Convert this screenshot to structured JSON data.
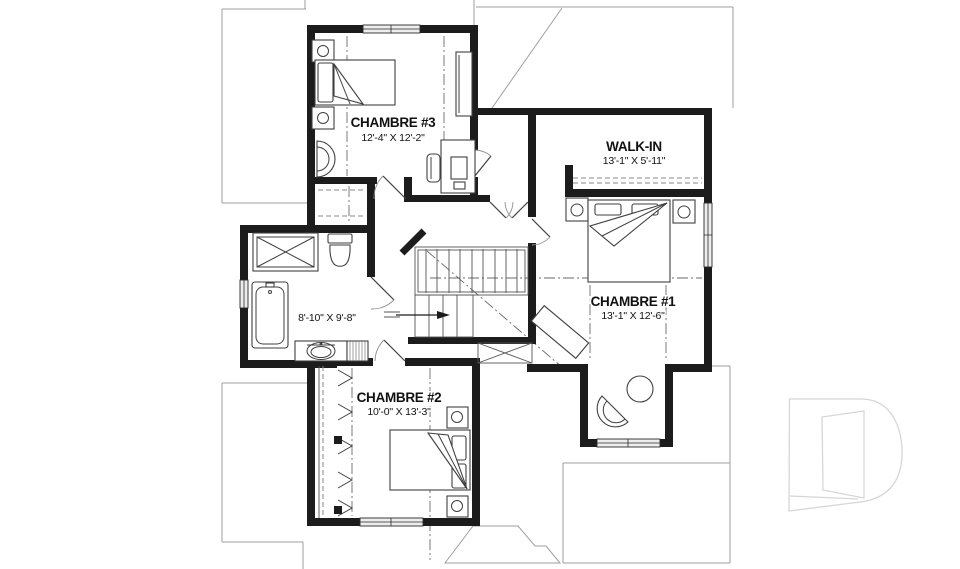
{
  "page": {
    "background": "#ffffff",
    "type": "architectural floor plan, upper storey"
  },
  "rooms": {
    "chambre3": {
      "name": "CHAMBRE #3",
      "dims": "12'-4\" X 12'-2\""
    },
    "walkin": {
      "name": "WALK-IN",
      "dims": "13'-1\" X 5'-11\""
    },
    "chambre1": {
      "name": "CHAMBRE #1",
      "dims": "13'-1\" X 12'-6\""
    },
    "chambre2": {
      "name": "CHAMBRE #2",
      "dims": "10'-0\" X 13'-3\""
    },
    "bathroom": {
      "dims": "8'-10\" X 9'-8\""
    }
  },
  "watermark": {
    "glyph": "D",
    "description": "light gray outlined letter-D builder logo"
  },
  "colors": {
    "wall": "#1c1c1c",
    "roofline": "#9f9f9f",
    "watermark": "#d6d6d6",
    "text": "#111111",
    "window_fill": "#ededed"
  }
}
